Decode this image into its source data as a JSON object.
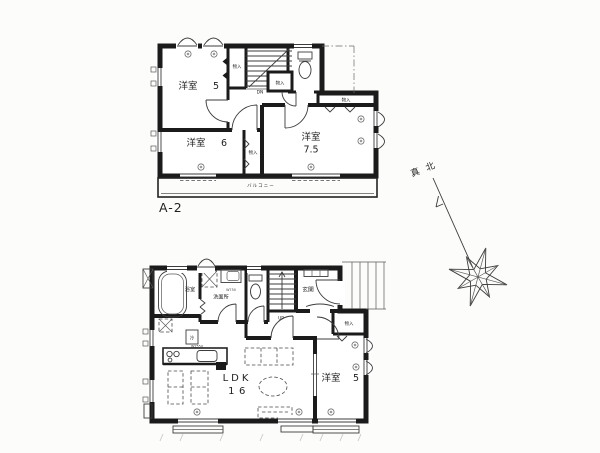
{
  "style": {
    "ink": "#1b1b1b",
    "paper": "#fcfcfa"
  },
  "floor2": {
    "plan_label": "A-2",
    "rooms": {
      "yoshitsu5": {
        "name": "洋室",
        "size": "5"
      },
      "yoshitsu6": {
        "name": "洋室",
        "size": "6"
      },
      "yoshitsu75": {
        "name": "洋室",
        "size": "7.5"
      }
    },
    "closets": {
      "c1": "物入",
      "c2": "物入",
      "c3": "物入",
      "c4": "物入"
    },
    "balcony_label": "バルコニー",
    "stair_label": "DN"
  },
  "floor1": {
    "rooms": {
      "bathroom": "浴室",
      "washroom": "洗面所",
      "entrance": "玄関",
      "ldk": {
        "name": "LDK",
        "size": "16"
      },
      "yoshitsu5": {
        "name": "洋室",
        "size": "5"
      }
    },
    "closet": "物入",
    "labels": {
      "fridge": "冷",
      "kitchen_width": "W2550",
      "vanity_width": "W750",
      "stair_label": "UP"
    }
  },
  "compass": {
    "north_label": "真北"
  }
}
